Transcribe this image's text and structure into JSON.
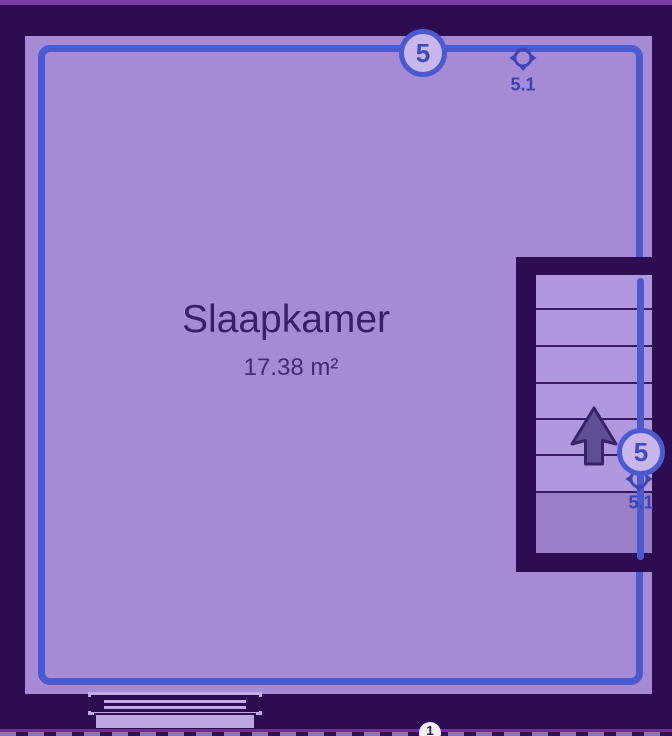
{
  "room": {
    "name": "Slaapkamer",
    "area": "17.38 m²"
  },
  "markers": {
    "top_wall_node": "5",
    "top_wall_viewpoint": "5.1",
    "stair_node": "5",
    "stair_viewpoint": "5.1",
    "bottom_wall_node": "1"
  },
  "stair": {
    "step_count": 6,
    "direction": "up"
  },
  "colors": {
    "exterior_wall": "#2d0c52",
    "room_floor": "#a78ad5",
    "selection_blue": "#4a5ad0",
    "marker_fill": "#c9b6ec",
    "marker_text": "#3c43b5",
    "room_text": "#3a1e66",
    "stair_floor": "#b197dd",
    "stair_landing": "#9a7ec6",
    "arrow": "#5f4d96",
    "top_bar": "#7b3ca8",
    "bottom_line": "#7226b3"
  }
}
